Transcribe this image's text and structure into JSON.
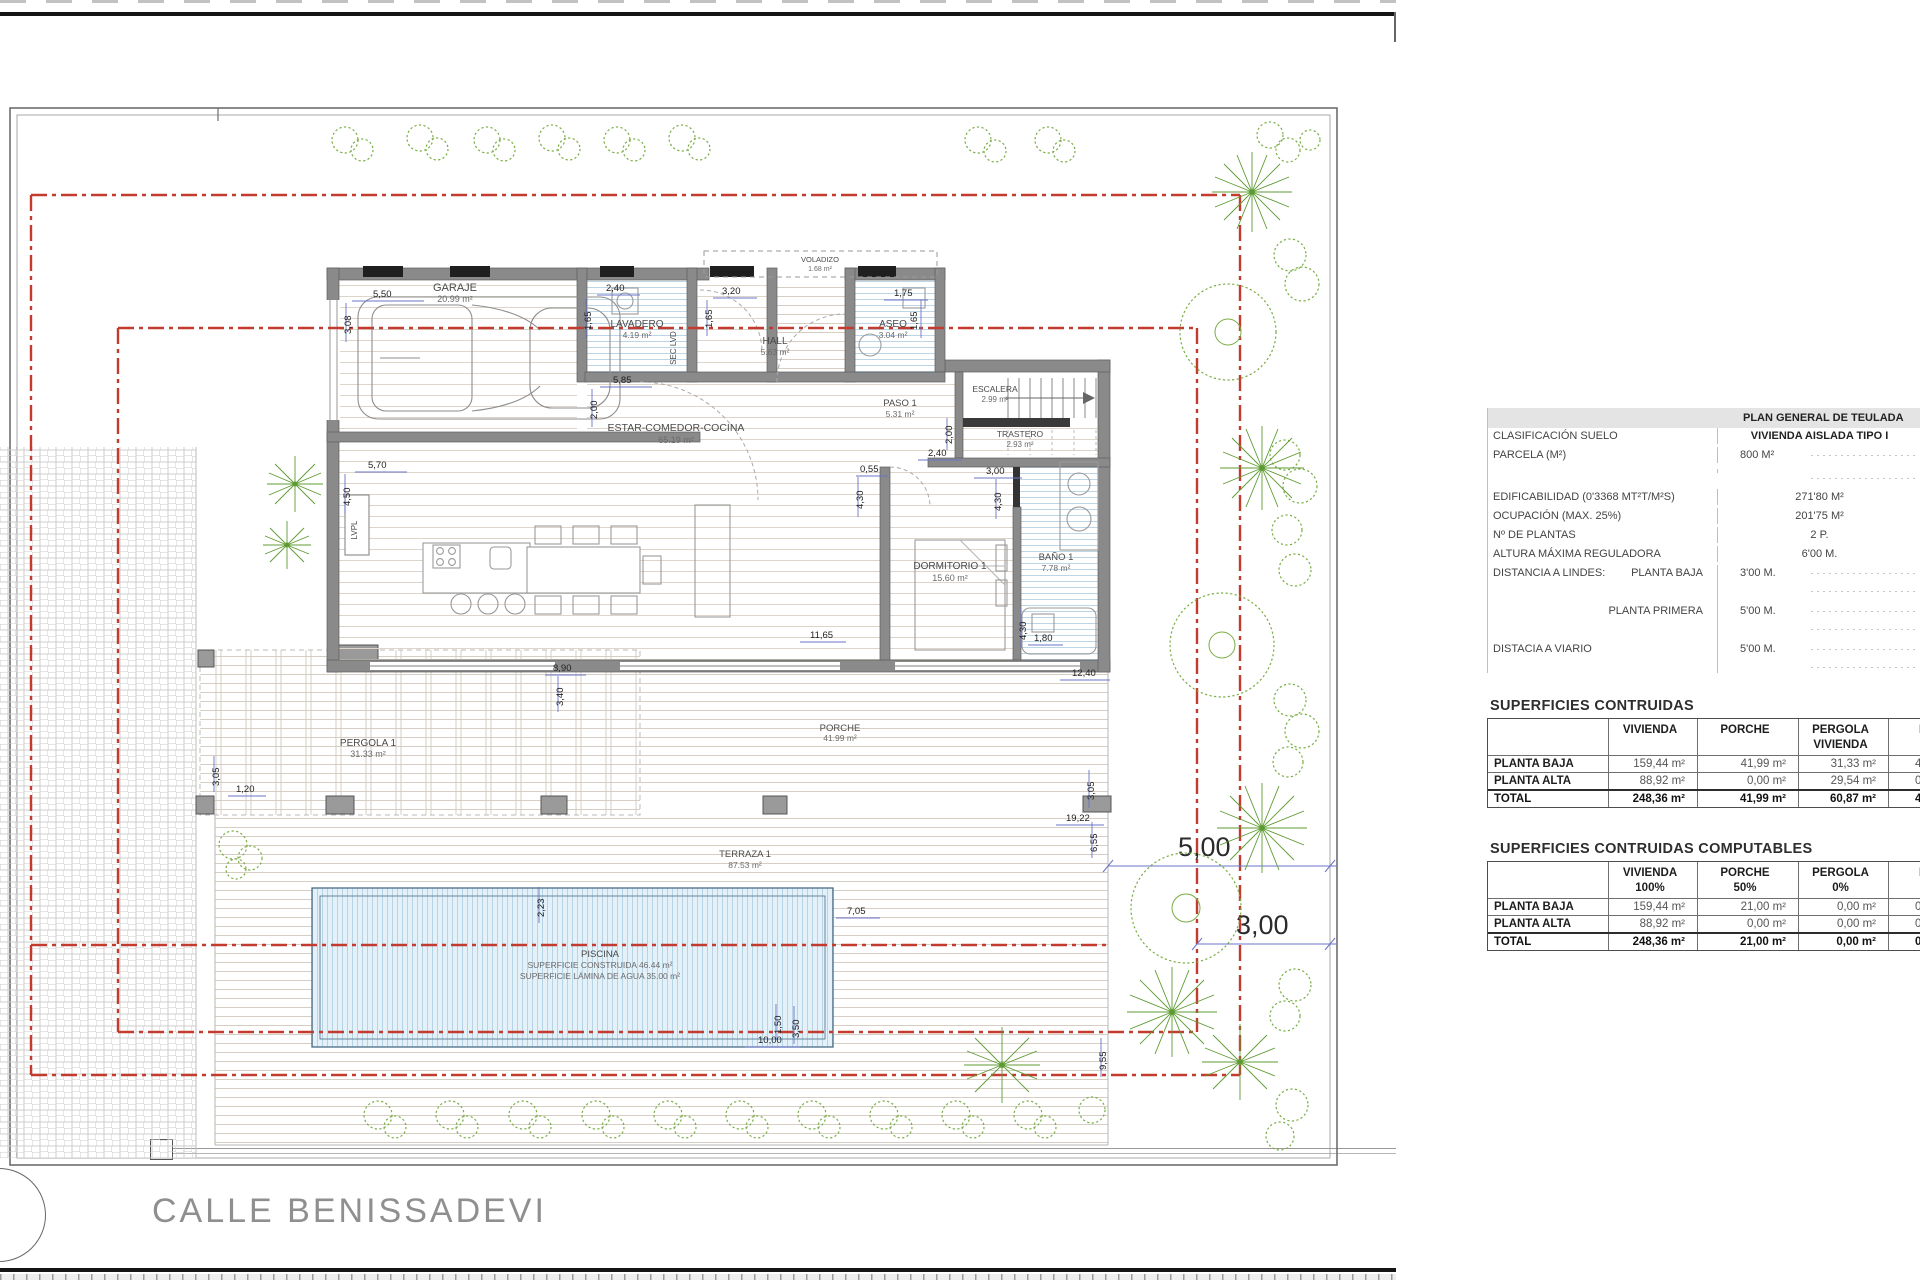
{
  "street": {
    "name": "CALLE BENISSADEVI"
  },
  "colors": {
    "wall": "#8a8a8a",
    "setback_red": "#c23b2e",
    "dim_blue": "#6a74c8",
    "vegetation_green": "#79ad43",
    "pool_water": "#e4f1f8",
    "table_accent": "#a6c7d8"
  },
  "plan_general": {
    "title": "PLAN GENERAL DE TEULADA",
    "rows": [
      {
        "label": "CLASIFICACIÓN SUELO",
        "label2": "",
        "value": "VIVIENDA AISLADA TIPO I"
      },
      {
        "label": "PARCELA (M²)",
        "label2": "",
        "value": "800 M²"
      },
      {
        "label": "",
        "label2": "",
        "value": ""
      },
      {
        "label": "EDIFICABILIDAD (0'3368 MT²T/M²S)",
        "label2": "",
        "value": "271'80 M²"
      },
      {
        "label": "OCUPACIÓN (MAX. 25%)",
        "label2": "",
        "value": "201'75 M²"
      },
      {
        "label": "Nº DE PLANTAS",
        "label2": "",
        "value": "2 P."
      },
      {
        "label": "ALTURA MÁXIMA REGULADORA",
        "label2": "",
        "value": "6'00 M."
      },
      {
        "label": "DISTANCIA A LINDES:",
        "label2": "PLANTA BAJA",
        "value": "3'00 M."
      },
      {
        "label": "",
        "label2": "PLANTA PRIMERA",
        "value": "5'00 M."
      },
      {
        "label": "DISTACIA A VIARIO",
        "label2": "",
        "value": "5'00 M."
      }
    ]
  },
  "superficies": {
    "title": "SUPERFICIES CONTRUIDAS",
    "headers": [
      "VIVIENDA",
      "PORCHE",
      "PERGOLA",
      "PIS"
    ],
    "headers2": [
      "",
      "",
      "VIVIENDA",
      ""
    ],
    "rows": [
      {
        "label": "PLANTA BAJA",
        "v": [
          "159,44 m²",
          "41,99 m²",
          "31,33 m²",
          "4"
        ]
      },
      {
        "label": "PLANTA ALTA",
        "v": [
          "88,92 m²",
          "0,00 m²",
          "29,54 m²",
          "0"
        ]
      },
      {
        "label": "TOTAL",
        "v": [
          "248,36 m²",
          "41,99 m²",
          "60,87 m²",
          "46"
        ]
      }
    ]
  },
  "computables": {
    "title": "SUPERFICIES CONTRUIDAS COMPUTABLES",
    "headers": [
      "VIVIENDA",
      "PORCHE",
      "PERGOLA",
      "PIS"
    ],
    "headers2": [
      "100%",
      "50%",
      "0%",
      ""
    ],
    "rows": [
      {
        "label": "PLANTA BAJA",
        "v": [
          "159,44 m²",
          "21,00 m²",
          "0,00 m²",
          "0"
        ]
      },
      {
        "label": "PLANTA ALTA",
        "v": [
          "88,92 m²",
          "0,00 m²",
          "0,00 m²",
          "0"
        ]
      },
      {
        "label": "TOTAL",
        "v": [
          "248,36 m²",
          "21,00 m²",
          "0,00 m²",
          "0"
        ]
      }
    ]
  },
  "rooms": {
    "garaje": {
      "name": "GARAJE",
      "area": "20.99 m²"
    },
    "lavadero": {
      "name": "LAVADERO",
      "area": "4.19 m²"
    },
    "seclvd": {
      "name": "SEC LVD"
    },
    "hall": {
      "name": "HALL",
      "area": "5.63 m²"
    },
    "voladizo": {
      "name": "VOLADIZO",
      "area": "1.68 m²"
    },
    "aseo": {
      "name": "ASEO",
      "area": "3.04 m²"
    },
    "paso": {
      "name": "PASO 1",
      "area": "5.31 m²"
    },
    "escalera": {
      "name": "ESCALERA",
      "area": "2.99 m²"
    },
    "trastero": {
      "name": "TRASTERO",
      "area": "2.93 m²"
    },
    "estar": {
      "name": "ESTAR-COMEDOR-COCINA",
      "area": "65.19 m²"
    },
    "dormitorio": {
      "name": "DORMITORIO 1",
      "area": "15.60 m²"
    },
    "bano": {
      "name": "BAÑO 1",
      "area": "7.78 m²"
    },
    "pergola": {
      "name": "PERGOLA 1",
      "area": "31.33 m²"
    },
    "porche": {
      "name": "PORCHE",
      "area": "41.99 m²"
    },
    "terraza": {
      "name": "TERRAZA 1",
      "area": "87.53 m²"
    },
    "lvpl": {
      "name": "LVPL"
    }
  },
  "pool": {
    "name": "PISCINA",
    "built": "SUPERFICIE CONSTRUIDA 46.44 m²",
    "water": "SUPERFICIE LÁMINA DE AGUA 35.00 m²"
  },
  "setbacks": {
    "front": "5,00",
    "side": "3,00"
  },
  "dims": {
    "garage_w": "5,50",
    "garage_h": "3,08",
    "lav_w": "2,40",
    "lav_h": "1,65",
    "hall_w": "3,20",
    "hall_h": "1,65",
    "aseo_w": "1,75",
    "aseo_h": "1,65",
    "estar_a": "5,85",
    "estar_b": "2,00",
    "estar_w": "5,70",
    "estar_h": "4,50",
    "tras_a": "2,00",
    "tras_b": "2,40",
    "dorm_a": "0,55",
    "dorm_b": "4,30",
    "dorm_c": "3,00",
    "dorm_d": "4,30",
    "bano_a": "4,30",
    "bano_b": "1,80",
    "house_w": "12,40",
    "deck_a": "8,90",
    "deck_b": "3,40",
    "deck_c": "11,65",
    "porch_a": "3,05",
    "porch_b": "19,22",
    "porch_c": "6,55",
    "side_a": "9,55",
    "terr_a": "7,05",
    "terr_b": "2,23",
    "pool_a": "1,50",
    "pool_w": "10,00",
    "pool_h": "3,50",
    "perg_a": "3,05",
    "perg_b": "1,20"
  }
}
